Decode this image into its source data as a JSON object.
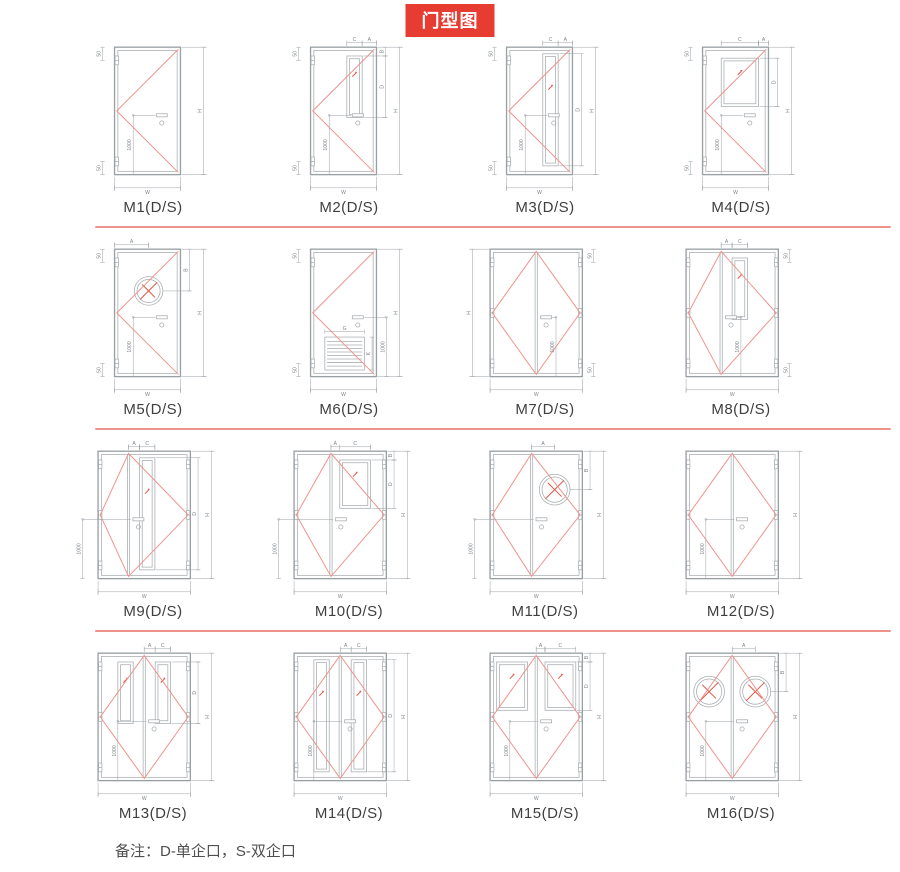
{
  "title": "门型图",
  "note": "备注：D-单企口，S-双企口",
  "colors": {
    "title_bg": "#e73c31",
    "title_text": "#ffffff",
    "divider": "#ee938c",
    "diagram_red": "#f0928c",
    "frame_gray": "#98a0a4",
    "label_text": "#3f3f3f"
  },
  "dim_labels": {
    "h": "H",
    "w": "W",
    "len": "1000",
    "hinge": "50"
  },
  "doors": [
    {
      "id": "M1",
      "label": "M1(D/S)",
      "type": "single",
      "split": 0,
      "window": "none",
      "perLeaf": false,
      "top": [],
      "win": [],
      "thousand": "inner",
      "hingeDim": "left",
      "h": true,
      "hSide": "right"
    },
    {
      "id": "M2",
      "label": "M2(D/S)",
      "type": "single",
      "split": 0,
      "window": "vrect",
      "perLeaf": false,
      "top": [
        "C",
        "A"
      ],
      "win": [
        "B",
        "D"
      ],
      "thousand": "inner",
      "hingeDim": "left",
      "h": true,
      "hSide": "right"
    },
    {
      "id": "M3",
      "label": "M3(D/S)",
      "type": "single",
      "split": 0,
      "window": "vfull",
      "perLeaf": false,
      "top": [
        "C",
        "A"
      ],
      "win": [
        "D"
      ],
      "thousand": "inner",
      "hingeDim": "left",
      "h": true,
      "hSide": "right"
    },
    {
      "id": "M4",
      "label": "M4(D/S)",
      "type": "single",
      "split": 0,
      "window": "rect",
      "perLeaf": false,
      "top": [
        "C",
        "A"
      ],
      "win": [
        "D"
      ],
      "thousand": "inner",
      "hingeDim": "left",
      "h": true,
      "hSide": "right"
    },
    {
      "id": "M5",
      "label": "M5(D/S)",
      "type": "single",
      "split": 0,
      "window": "circle",
      "perLeaf": false,
      "top": [
        "A"
      ],
      "win": [
        "B"
      ],
      "thousand": "inner",
      "hingeDim": "left",
      "h": true,
      "hSide": "right"
    },
    {
      "id": "M6",
      "label": "M6(D/S)",
      "type": "single",
      "split": 0,
      "window": "louver",
      "perLeaf": false,
      "top": [],
      "win": [
        "G",
        "K"
      ],
      "thousand": "right",
      "hingeDim": "left",
      "h": true,
      "hSide": "right"
    },
    {
      "id": "M7",
      "label": "M7(D/S)",
      "type": "double",
      "split": 0.5,
      "window": "none",
      "perLeaf": false,
      "top": [],
      "win": [],
      "thousand": "divR",
      "hingeDim": "right",
      "h": true,
      "hSide": "left"
    },
    {
      "id": "M8",
      "label": "M8(D/S)",
      "type": "double",
      "split": 0.38,
      "window": "vrect",
      "perLeaf": false,
      "top": [
        "A",
        "C"
      ],
      "win": [],
      "thousand": "divR",
      "hingeDim": "right",
      "h": false,
      "hSide": "right"
    },
    {
      "id": "M9",
      "label": "M9(D/S)",
      "type": "double",
      "split": 0.33,
      "window": "vfull",
      "perLeaf": false,
      "top": [
        "A",
        "C"
      ],
      "win": [
        "D"
      ],
      "thousand": "outL",
      "hingeDim": null,
      "h": true,
      "hSide": "right"
    },
    {
      "id": "M10",
      "label": "M10(D/S)",
      "type": "double",
      "split": 0.4,
      "window": "rect",
      "perLeaf": false,
      "top": [
        "A",
        "C"
      ],
      "win": [
        "B",
        "D"
      ],
      "thousand": "outL",
      "hingeDim": null,
      "h": true,
      "hSide": "right"
    },
    {
      "id": "M11",
      "label": "M11(D/S)",
      "type": "double",
      "split": 0.45,
      "window": "circle",
      "perLeaf": false,
      "top": [
        "A"
      ],
      "win": [
        "B"
      ],
      "thousand": "outL",
      "hingeDim": null,
      "h": true,
      "hSide": "right"
    },
    {
      "id": "M12",
      "label": "M12(D/S)",
      "type": "double",
      "split": 0.5,
      "window": "none",
      "perLeaf": false,
      "top": [],
      "win": [],
      "thousand": "divL",
      "hingeDim": null,
      "h": true,
      "hSide": "right"
    },
    {
      "id": "M13",
      "label": "M13(D/S)",
      "type": "double",
      "split": 0.5,
      "window": "vrect",
      "perLeaf": true,
      "top": [
        "A",
        "C"
      ],
      "win": [
        "D"
      ],
      "thousand": "divL",
      "hingeDim": null,
      "h": true,
      "hSide": "right"
    },
    {
      "id": "M14",
      "label": "M14(D/S)",
      "type": "double",
      "split": 0.5,
      "window": "vfull",
      "perLeaf": true,
      "top": [
        "A",
        "C"
      ],
      "win": [
        "D"
      ],
      "thousand": "divL",
      "hingeDim": null,
      "h": true,
      "hSide": "right"
    },
    {
      "id": "M15",
      "label": "M15(D/S)",
      "type": "double",
      "split": 0.5,
      "window": "rect",
      "perLeaf": true,
      "top": [
        "A",
        "C"
      ],
      "win": [
        "B",
        "D"
      ],
      "thousand": "divL",
      "hingeDim": null,
      "h": true,
      "hSide": "right"
    },
    {
      "id": "M16",
      "label": "M16(D/S)",
      "type": "double",
      "split": 0.5,
      "window": "circle",
      "perLeaf": true,
      "top": [
        "A"
      ],
      "win": [
        "B"
      ],
      "thousand": "divL",
      "hingeDim": null,
      "h": true,
      "hSide": "right"
    }
  ]
}
